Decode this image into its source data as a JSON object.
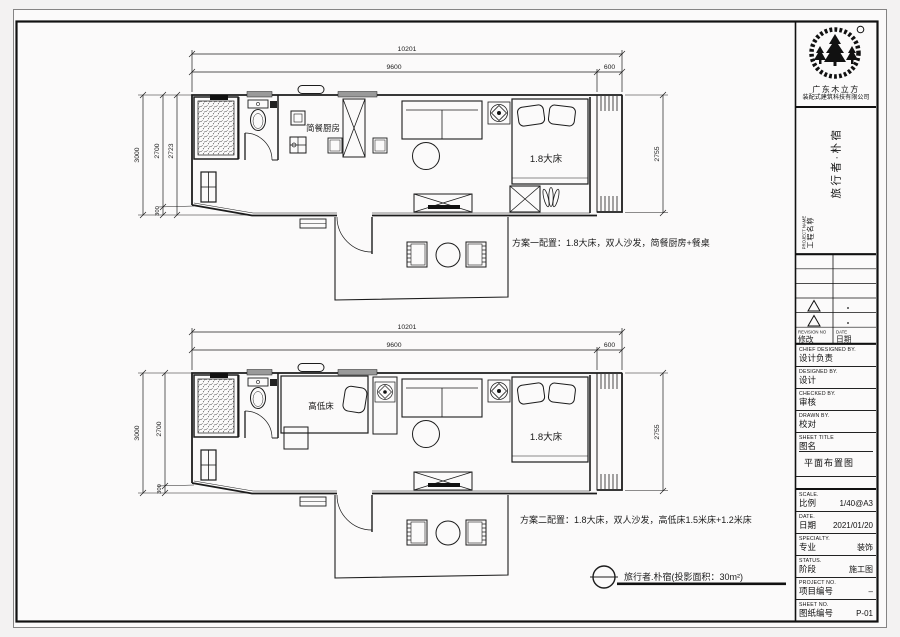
{
  "colors": {
    "line": "#1c1c1c",
    "paper": "#fbfafa",
    "window_fill": "#9a9a9a"
  },
  "plans": {
    "top": {
      "dims": {
        "overall": "10201",
        "main": "9600",
        "ext": "600",
        "left_outer": "3000",
        "left_mid": "2700",
        "left_inner": "2723",
        "left_small": "300",
        "right": "2755"
      },
      "labels": {
        "kitchen": "简餐厨房",
        "bed": "1.8大床"
      },
      "caption": "方案一配置：1.8大床，双人沙发，简餐厨房+餐桌"
    },
    "bottom": {
      "dims": {
        "overall": "10201",
        "main": "9600",
        "ext": "600",
        "left_outer": "3000",
        "left_mid": "2700",
        "left_small": "300",
        "right": "2755"
      },
      "labels": {
        "bunk": "高低床",
        "bed": "1.8大床"
      },
      "caption": "方案二配置：1.8大床，双人沙发，高低床1.5米床+1.2米床"
    }
  },
  "footer": {
    "label": "旅行者.朴宿(投影面积：30m²)"
  },
  "titleblock": {
    "company": {
      "line1": "广东木立方",
      "line2": "装配式建筑科技有限公司"
    },
    "project_title": "旅行者·朴宿",
    "project_name": {
      "en": "PROJECT NAME",
      "zh": "工程名称"
    },
    "revision": {
      "no_en": "REVISION NO",
      "no_zh": "修改",
      "date_en": "DATE",
      "date_zh": "日期"
    },
    "sign_fields": [
      {
        "en": "CHIEF DESIGNED BY.",
        "zh": "设计负责"
      },
      {
        "en": "DESIGNED BY.",
        "zh": "设计"
      },
      {
        "en": "CHECKED BY.",
        "zh": "审核"
      },
      {
        "en": "DRAWN BY.",
        "zh": "校对"
      }
    ],
    "sheet_title": {
      "en": "SHEET TITLE",
      "zh": "图名",
      "value": "平面布置图"
    },
    "info_fields": [
      {
        "en": "SCALE.",
        "zh": "比例",
        "value": "1/40@A3"
      },
      {
        "en": "DATE.",
        "zh": "日期",
        "value": "2021/01/20"
      },
      {
        "en": "SPECIALTY.",
        "zh": "专业",
        "value": "装饰"
      },
      {
        "en": "STATUS.",
        "zh": "阶段",
        "value": "施工图"
      },
      {
        "en": "PROJECT NO.",
        "zh": "项目编号",
        "value": "–"
      },
      {
        "en": "SHEET NO.",
        "zh": "图纸编号",
        "value": "P-01"
      }
    ]
  }
}
